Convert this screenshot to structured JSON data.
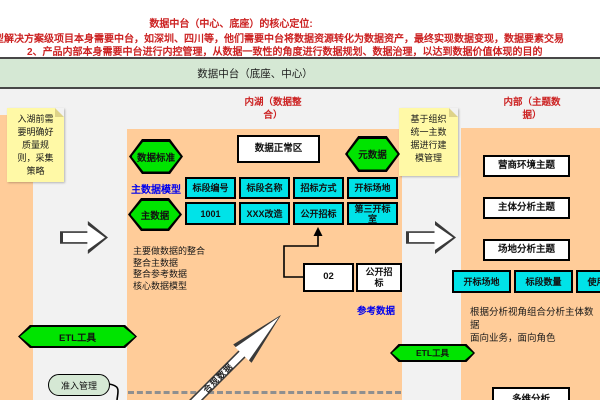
{
  "top_notes": {
    "line1": "数据中台（中心、底座）的核心定位:",
    "line2": "型解决方案级项目本身需要中台，如深圳、四川等，他们需要中台将数据资源转化为数据资产，最终实现数据变现，数据要素交易",
    "line3": "2、产品内部本身需要中台进行内控管理，从数据一致性的角度进行数据规划、数据治理，以达到数据价值体现的目的"
  },
  "title_band": {
    "label": "数据中台（底座、中心）"
  },
  "sticky_left": {
    "text": "入湖前需\n要明确好\n质量规\n则，采集\n策略"
  },
  "sticky_right": {
    "text": "基于组织\n统一主数\n据进行建\n模管理"
  },
  "inner_lake": {
    "label": "内湖（数据整\n合）",
    "hex_data_standard": "数据标准",
    "hex_metadata": "元数据",
    "hex_master_data": "主数据",
    "normal_zone": "数据正常区",
    "master_model_label": "主数据模型",
    "table": {
      "headers": [
        "标段编号",
        "标段名称",
        "招标方式",
        "开标场地"
      ],
      "row": [
        "1001",
        "XXX改造",
        "公开招标",
        "第三开标\n室"
      ]
    },
    "notes": "主要做数据的整合\n整合主数据\n整合参考数据\n核心数据模型",
    "ref_code_box": "02",
    "ref_value_box": "公开招\n标",
    "ref_data_label": "参考数据",
    "compliance_arrow_label": "合规数据"
  },
  "subject_area": {
    "label": "内部（主题数\n据）",
    "topics": [
      "营商环境主题",
      "主体分析主题",
      "场地分析主题"
    ],
    "dims": [
      "开标场地",
      "标段数量",
      "使用频次"
    ],
    "desc": "根据分析视角组合分析主体数\n据\n面向业务，面向角色",
    "bottom_box": "多维分析"
  },
  "tools": {
    "etl_left": "ETL工具",
    "etl_right": "ETL工具",
    "access_mgmt": "准入管理"
  },
  "colors": {
    "orange": "#FFCC99",
    "bright_green": "#00E400",
    "cyan": "#00E3E8",
    "sticky_yellow": "#FFF9A6",
    "band_green": "#D5E8D4",
    "note_red": "#CC2222",
    "link_blue": "#0000EE",
    "bg_gray": "#F2F2F2"
  }
}
